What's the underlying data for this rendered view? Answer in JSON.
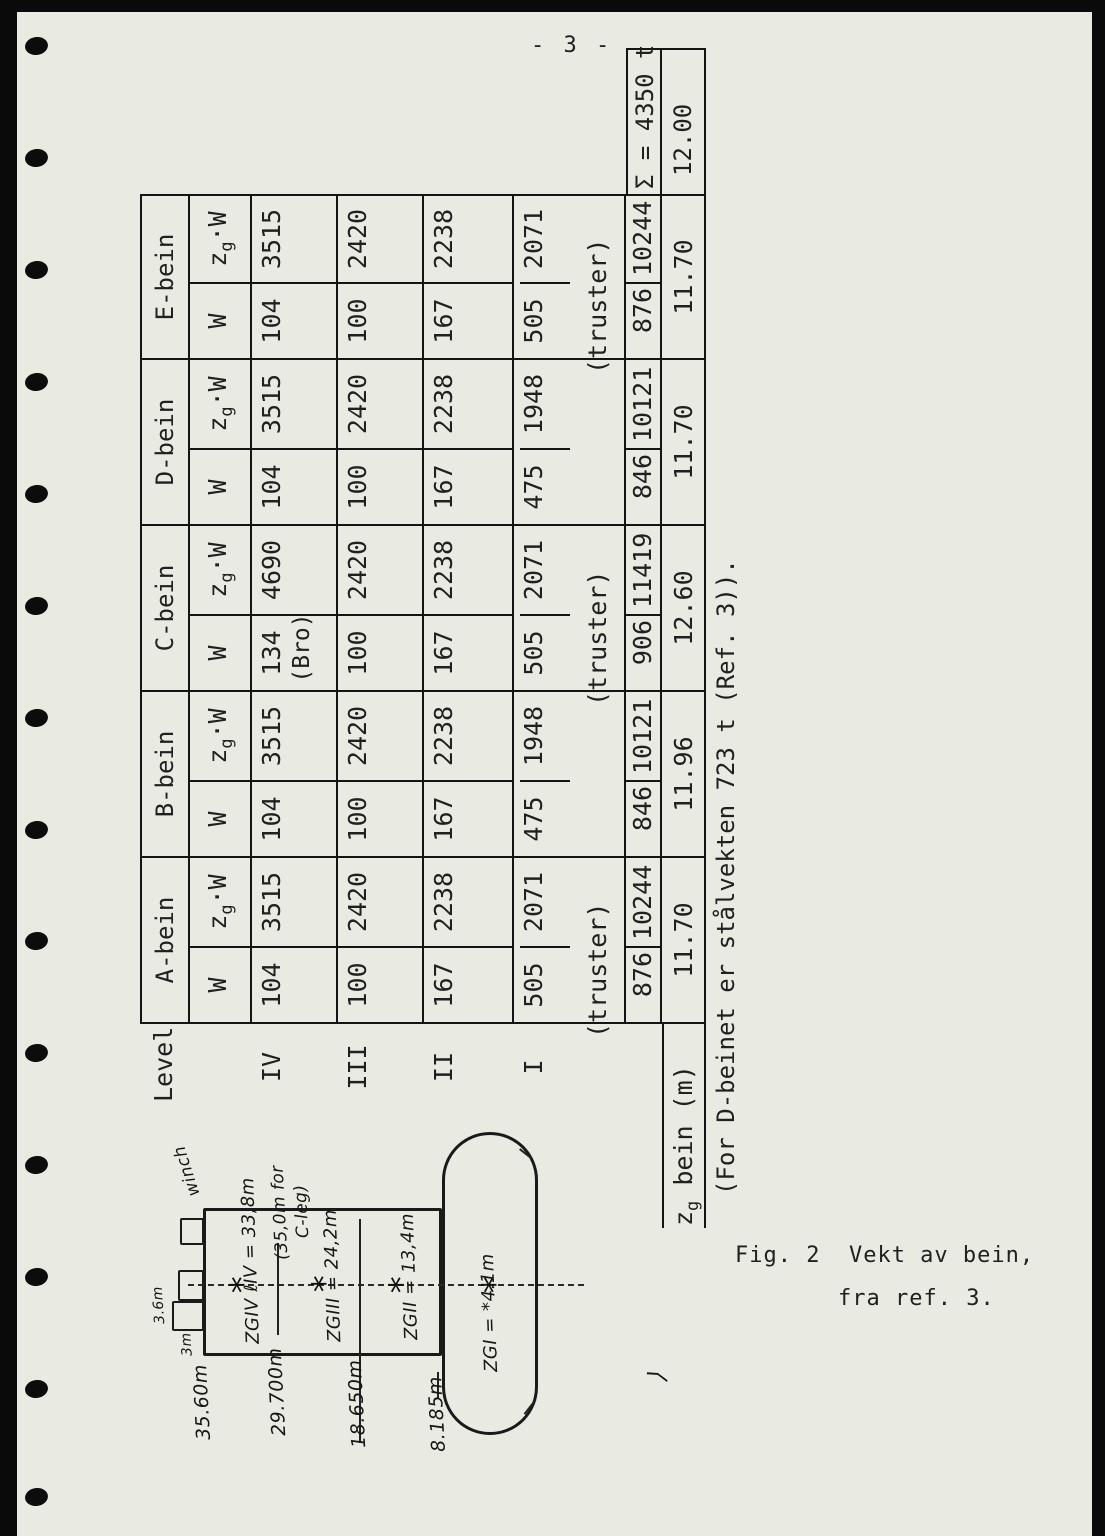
{
  "colors": {
    "paper": "#e9ebe3",
    "ink": "#202020",
    "line": "#141414",
    "edge": "#0a0a0a"
  },
  "page": {
    "number": "- 3 -",
    "note": "(For D-beinet er stålvekten 723 t (Ref. 3)).",
    "caption_line1": "Fig. 2  Vekt av bein,",
    "caption_line2": "fra ref. 3."
  },
  "table": {
    "corner_label": "Level",
    "sub_w": "W",
    "sub_zg_z": "z",
    "sub_zg_g": "g",
    "sub_zg_w": "·W",
    "row_labels": [
      "IV",
      "III",
      "II",
      "I"
    ],
    "zg_label_z": "z",
    "zg_label_g": "g",
    "zg_label_rest": " bein (m)",
    "sum_label": "Σ = 4350 t",
    "overall_zg": "12.00",
    "beins": [
      {
        "label": "A-bein",
        "IV": {
          "w": "104",
          "zgw": "3515"
        },
        "III": {
          "w": "100",
          "zgw": "2420"
        },
        "II": {
          "w": "167",
          "zgw": "2238"
        },
        "I": {
          "w": "505",
          "zgw": "2071",
          "note": "(truster)"
        },
        "total_w": "876",
        "total_zgw": "10244",
        "zg": "11.70"
      },
      {
        "label": "B-bein",
        "IV": {
          "w": "104",
          "zgw": "3515"
        },
        "III": {
          "w": "100",
          "zgw": "2420"
        },
        "II": {
          "w": "167",
          "zgw": "2238"
        },
        "I": {
          "w": "475",
          "zgw": "1948",
          "note": ""
        },
        "total_w": "846",
        "total_zgw": "10121",
        "zg": "11.96"
      },
      {
        "label": "C-bein",
        "IV": {
          "w": "134",
          "zgw": "4690",
          "note": "(Bro)"
        },
        "III": {
          "w": "100",
          "zgw": "2420"
        },
        "II": {
          "w": "167",
          "zgw": "2238"
        },
        "I": {
          "w": "505",
          "zgw": "2071",
          "note": "(truster)"
        },
        "total_w": "906",
        "total_zgw": "11419",
        "zg": "12.60"
      },
      {
        "label": "D-bein",
        "IV": {
          "w": "104",
          "zgw": "3515"
        },
        "III": {
          "w": "100",
          "zgw": "2420"
        },
        "II": {
          "w": "167",
          "zgw": "2238"
        },
        "I": {
          "w": "475",
          "zgw": "1948",
          "note": ""
        },
        "total_w": "846",
        "total_zgw": "10121",
        "zg": "11.70"
      },
      {
        "label": "E-bein",
        "IV": {
          "w": "104",
          "zgw": "3515"
        },
        "III": {
          "w": "100",
          "zgw": "2420"
        },
        "II": {
          "w": "167",
          "zgw": "2238"
        },
        "I": {
          "w": "505",
          "zgw": "2071",
          "note": "(truster)"
        },
        "total_w": "876",
        "total_zgw": "10244",
        "zg": "11.70"
      }
    ]
  },
  "figure": {
    "winch_label": "winch",
    "dim_tall": "3.6m",
    "dim_short": "3m",
    "elev_top": "35.60m",
    "elev_iv": "29.700m",
    "elev_iii": "18.650m",
    "elev_i": "8.185m",
    "zg_iv": "ZGIV ℓIV = 33,8m",
    "zg_iv_alt1": "(35,0m for",
    "zg_iv_alt2": "C-leg)",
    "zg_iii": "ZGIII = 24,2m",
    "zg_ii": "ZGII = 13,4m",
    "zg_i": "ZGI = *4.1m",
    "axis_mark": "*",
    "corner_mark": "⟩"
  }
}
